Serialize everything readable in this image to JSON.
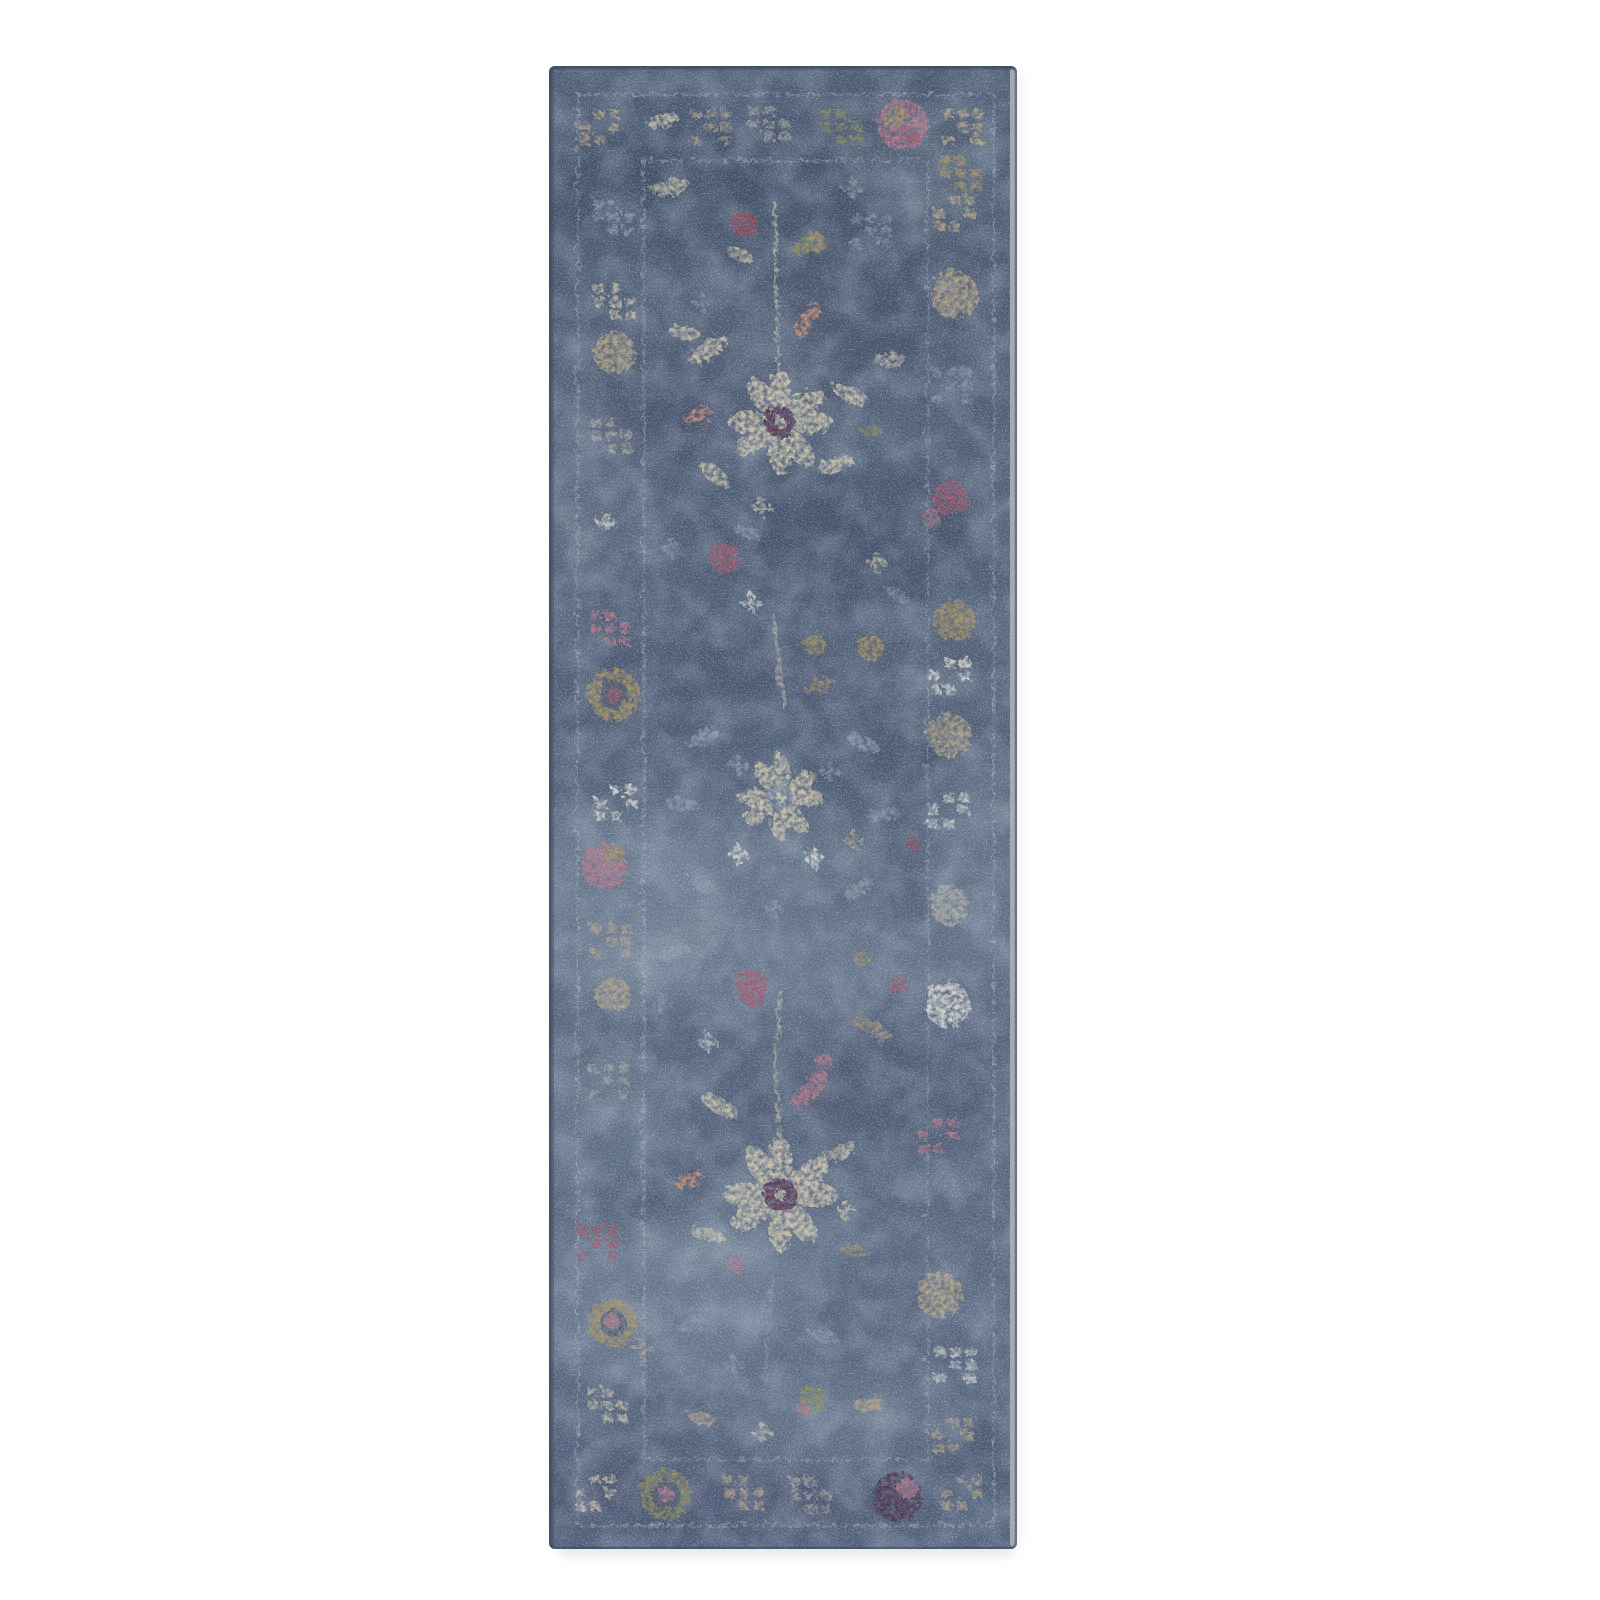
{
  "page": {
    "background_color": "#ffffff"
  },
  "photo": {
    "alt": "Product photo of a vintage-style distressed runner rug in slate blue with faded multicolor floral motifs in cream, beige, gold, olive, pink and rose, framed by a tone-on-tone bordered edge, on a plain white background",
    "width_px": 1600,
    "height_px": 1600
  },
  "rug": {
    "x": 549,
    "y": 66,
    "width": 468,
    "height": 1483,
    "corner_radius": 6,
    "palette": {
      "cream": "#d8cdb0",
      "beige": "#c2ad86",
      "gold": "#b0985e",
      "olive": "#8f9054",
      "dim": "#97a5b4",
      "white": "#e8e5d9",
      "graycream": "#c6c0ae",
      "pink": "#c2798a",
      "rose": "#ae5468",
      "red": "#a84352",
      "salmon": "#cf8f72",
      "maroon": "#5d2b44",
      "purple": "#4c2b46",
      "line": "#b6c0ca",
      "edge": "#a9b0b8",
      "patch_dark": "#2f3b52",
      "patch_light": "#94a4b4",
      "edge_shade": "#434e60",
      "outline": "#38445a",
      "shadow": "#cfd3d6"
    },
    "guard_lines": [
      {
        "inset": 26,
        "o": 0.55
      },
      {
        "inset": 92,
        "o": 0.5
      }
    ],
    "patches": [
      [
        707,
        190,
        170,
        60,
        "d",
        0.32
      ],
      [
        880,
        300,
        90,
        80,
        "d",
        0.25
      ],
      [
        640,
        420,
        80,
        50,
        "d",
        0.22
      ],
      [
        845,
        540,
        130,
        70,
        "d",
        0.3
      ],
      [
        700,
        690,
        120,
        45,
        "d",
        0.22
      ],
      [
        870,
        760,
        90,
        50,
        "d",
        0.2
      ],
      [
        640,
        1180,
        70,
        60,
        "d",
        0.2
      ],
      [
        865,
        1095,
        120,
        55,
        "d",
        0.25
      ],
      [
        700,
        1500,
        190,
        45,
        "d",
        0.22
      ],
      [
        950,
        1450,
        70,
        50,
        "d",
        0.2
      ],
      [
        615,
        905,
        110,
        95,
        "l",
        0.35
      ],
      [
        770,
        960,
        170,
        55,
        "l",
        0.28
      ],
      [
        660,
        1300,
        140,
        80,
        "l",
        0.3
      ],
      [
        850,
        1420,
        120,
        45,
        "l",
        0.22
      ],
      [
        600,
        1120,
        80,
        70,
        "l",
        0.25
      ],
      [
        980,
        870,
        50,
        120,
        "l",
        0.22
      ],
      [
        760,
        1240,
        90,
        40,
        "l",
        0.2
      ],
      [
        930,
        180,
        60,
        40,
        "l",
        0.18
      ],
      [
        580,
        480,
        50,
        90,
        "l",
        0.2
      ],
      [
        760,
        860,
        120,
        40,
        "l",
        0.25
      ]
    ],
    "motifs": [
      {
        "t": "blocks",
        "x": 596,
        "y": 124,
        "c": "beige"
      },
      {
        "t": "leaf",
        "x": 660,
        "y": 118,
        "w": 16,
        "h": 7,
        "rot": -15,
        "c": "cream"
      },
      {
        "t": "blocks",
        "x": 708,
        "y": 124,
        "c": "beige",
        "o": 0.7
      },
      {
        "t": "blocks",
        "x": 766,
        "y": 121,
        "c": "graycream",
        "o": 0.6
      },
      {
        "t": "blocks",
        "x": 838,
        "y": 124,
        "c": "olive",
        "o": 0.75
      },
      {
        "t": "ball",
        "x": 900,
        "y": 122,
        "r": 26,
        "c": "pink"
      },
      {
        "t": "ball",
        "x": 893,
        "y": 114,
        "r": 12,
        "c": "gold",
        "o": 0.8
      },
      {
        "t": "ball",
        "x": 909,
        "y": 133,
        "r": 9,
        "c": "rose",
        "o": 0.8
      },
      {
        "t": "blocks",
        "x": 960,
        "y": 124,
        "c": "beige",
        "o": 0.85
      },
      {
        "t": "blocks",
        "x": 610,
        "y": 214,
        "c": "dim",
        "o": 0.75
      },
      {
        "t": "blocks",
        "x": 612,
        "y": 299,
        "c": "cream",
        "o": 0.8
      },
      {
        "t": "ball",
        "x": 612,
        "y": 350,
        "r": 21,
        "c": "beige"
      },
      {
        "t": "blocks",
        "x": 608,
        "y": 432,
        "c": "graycream",
        "o": 0.6
      },
      {
        "t": "star",
        "x": 604,
        "y": 520,
        "c": "white",
        "o": 0.8
      },
      {
        "t": "blocks",
        "x": 607,
        "y": 625,
        "c": "pink",
        "o": 0.85
      },
      {
        "t": "ring",
        "x": 611,
        "y": 692,
        "r": 26,
        "c": "gold",
        "c2": "rose"
      },
      {
        "t": "blocks",
        "x": 613,
        "y": 800,
        "c": "white",
        "o": 0.85
      },
      {
        "t": "ball",
        "x": 602,
        "y": 864,
        "r": 23,
        "c": "pink"
      },
      {
        "t": "ball",
        "x": 612,
        "y": 852,
        "r": 10,
        "c": "gold",
        "o": 0.85
      },
      {
        "t": "blocks",
        "x": 608,
        "y": 938,
        "c": "beige",
        "o": 0.7
      },
      {
        "t": "ball",
        "x": 610,
        "y": 992,
        "r": 18,
        "c": "beige",
        "o": 0.8
      },
      {
        "t": "blocks",
        "x": 606,
        "y": 1078,
        "c": "graycream",
        "o": 0.6
      },
      {
        "t": "blocks",
        "x": 594,
        "y": 1240,
        "c": "rose",
        "o": 0.8
      },
      {
        "t": "ring",
        "x": 610,
        "y": 1320,
        "r": 24,
        "c": "gold",
        "c2": "pink"
      },
      {
        "t": "blocks",
        "x": 604,
        "y": 1402,
        "c": "cream",
        "o": 0.75
      },
      {
        "t": "blocks",
        "x": 957,
        "y": 170,
        "c": "gold",
        "o": 0.8
      },
      {
        "t": "blocks",
        "x": 951,
        "y": 210,
        "c": "beige",
        "o": 0.8
      },
      {
        "t": "ball",
        "x": 952,
        "y": 292,
        "r": 24,
        "c": "beige",
        "o": 0.85
      },
      {
        "t": "blocks",
        "x": 948,
        "y": 382,
        "c": "dim",
        "o": 0.6
      },
      {
        "t": "ball",
        "x": 948,
        "y": 496,
        "r": 18,
        "c": "rose",
        "o": 0.85
      },
      {
        "t": "ball",
        "x": 952,
        "y": 618,
        "r": 21,
        "c": "gold",
        "o": 0.85
      },
      {
        "t": "blocks",
        "x": 947,
        "y": 673,
        "c": "white",
        "o": 0.85
      },
      {
        "t": "ball",
        "x": 947,
        "y": 733,
        "r": 22,
        "c": "beige",
        "o": 0.8
      },
      {
        "t": "blocks",
        "x": 945,
        "y": 807,
        "c": "white",
        "o": 0.75
      },
      {
        "t": "ball",
        "x": 947,
        "y": 903,
        "r": 20,
        "c": "graycream",
        "o": 0.7
      },
      {
        "t": "ball",
        "x": 910,
        "y": 842,
        "r": 6,
        "c": "red",
        "o": 0.7
      },
      {
        "t": "ball",
        "x": 945,
        "y": 1002,
        "r": 23,
        "c": "white",
        "o": 0.9
      },
      {
        "t": "blocks",
        "x": 935,
        "y": 1132,
        "c": "pink",
        "o": 0.8
      },
      {
        "t": "ball",
        "x": 937,
        "y": 1292,
        "r": 23,
        "c": "beige",
        "o": 0.85
      },
      {
        "t": "blocks",
        "x": 952,
        "y": 1362,
        "c": "white",
        "o": 0.7
      },
      {
        "t": "blocks",
        "x": 950,
        "y": 1432,
        "c": "beige",
        "o": 0.7
      },
      {
        "t": "blocks",
        "x": 592,
        "y": 1490,
        "c": "cream",
        "o": 0.8
      },
      {
        "t": "ring",
        "x": 663,
        "y": 1492,
        "r": 26,
        "c": "olive",
        "c2": "pink"
      },
      {
        "t": "blocks",
        "x": 741,
        "y": 1490,
        "c": "beige",
        "o": 0.8
      },
      {
        "t": "blocks",
        "x": 808,
        "y": 1492,
        "c": "graycream",
        "o": 0.6
      },
      {
        "t": "ball",
        "x": 895,
        "y": 1494,
        "r": 25,
        "c": "purple"
      },
      {
        "t": "ball",
        "x": 905,
        "y": 1486,
        "r": 10,
        "c": "pink",
        "o": 0.85
      },
      {
        "t": "blocks",
        "x": 958,
        "y": 1490,
        "c": "beige",
        "o": 0.75
      },
      {
        "t": "leaf",
        "x": 668,
        "y": 185,
        "w": 20,
        "h": 8,
        "rot": -10,
        "c": "cream",
        "o": 0.8
      },
      {
        "t": "star",
        "x": 850,
        "y": 186,
        "c": "dim",
        "o": 0.7
      },
      {
        "t": "blocks",
        "x": 868,
        "y": 228,
        "c": "dim",
        "o": 0.65
      },
      {
        "t": "stem",
        "x": 772,
        "y": 200,
        "x2": 776,
        "y2": 395,
        "c": "cream",
        "o": 0.7
      },
      {
        "t": "ball",
        "x": 742,
        "y": 221,
        "r": 13,
        "c": "red",
        "o": 0.85
      },
      {
        "t": "leaf",
        "x": 800,
        "y": 243,
        "w": 16,
        "h": 7,
        "rot": -30,
        "c": "olive"
      },
      {
        "t": "ball",
        "x": 813,
        "y": 240,
        "r": 10,
        "c": "gold",
        "o": 0.8
      },
      {
        "t": "leaf",
        "x": 737,
        "y": 252,
        "w": 14,
        "h": 6,
        "rot": 20,
        "c": "cream",
        "o": 0.8
      },
      {
        "t": "leaf",
        "x": 806,
        "y": 318,
        "w": 20,
        "h": 7,
        "rot": -55,
        "c": "salmon",
        "o": 0.9
      },
      {
        "t": "star",
        "x": 700,
        "y": 300,
        "c": "dim",
        "o": 0.6
      },
      {
        "t": "flower",
        "x": 778,
        "y": 420,
        "r": 52,
        "c": "cream",
        "c2": "maroon"
      },
      {
        "t": "leaf",
        "x": 706,
        "y": 348,
        "w": 22,
        "h": 9,
        "rot": -35,
        "c": "cream"
      },
      {
        "t": "leaf",
        "x": 682,
        "y": 330,
        "w": 16,
        "h": 7,
        "rot": 10,
        "c": "cream",
        "o": 0.8
      },
      {
        "t": "bird",
        "x": 695,
        "y": 413,
        "c": "salmon"
      },
      {
        "t": "leaf",
        "x": 848,
        "y": 392,
        "w": 20,
        "h": 8,
        "rot": 25,
        "c": "cream",
        "o": 0.9
      },
      {
        "t": "leaf",
        "x": 887,
        "y": 357,
        "w": 16,
        "h": 7,
        "rot": -5,
        "c": "graycream",
        "o": 0.8
      },
      {
        "t": "leaf",
        "x": 833,
        "y": 462,
        "w": 20,
        "h": 8,
        "rot": -15,
        "c": "cream",
        "o": 0.9
      },
      {
        "t": "leaf",
        "x": 712,
        "y": 472,
        "w": 18,
        "h": 8,
        "rot": 40,
        "c": "cream",
        "o": 0.85
      },
      {
        "t": "star",
        "x": 760,
        "y": 505,
        "c": "cream",
        "o": 0.8
      },
      {
        "t": "leaf",
        "x": 868,
        "y": 428,
        "w": 12,
        "h": 5,
        "rot": 0,
        "c": "olive",
        "o": 0.8
      },
      {
        "t": "ball",
        "x": 722,
        "y": 556,
        "r": 15,
        "c": "rose",
        "o": 0.85
      },
      {
        "t": "star",
        "x": 748,
        "y": 600,
        "c": "white",
        "o": 0.9
      },
      {
        "t": "stem",
        "x": 770,
        "y": 612,
        "x2": 782,
        "y2": 705,
        "c": "cream",
        "o": 0.6
      },
      {
        "t": "ball",
        "x": 812,
        "y": 642,
        "r": 11,
        "c": "gold",
        "o": 0.8
      },
      {
        "t": "ball",
        "x": 868,
        "y": 645,
        "r": 13,
        "c": "gold",
        "o": 0.85
      },
      {
        "t": "leaf",
        "x": 818,
        "y": 684,
        "w": 16,
        "h": 7,
        "rot": -20,
        "c": "gold",
        "o": 0.7
      },
      {
        "t": "star",
        "x": 668,
        "y": 545,
        "c": "dim",
        "o": 0.6
      },
      {
        "t": "leaf",
        "x": 745,
        "y": 530,
        "w": 14,
        "h": 6,
        "rot": 15,
        "c": "dim",
        "o": 0.7
      },
      {
        "t": "ball",
        "x": 928,
        "y": 515,
        "r": 9,
        "c": "pink",
        "o": 0.7
      },
      {
        "t": "star",
        "x": 874,
        "y": 560,
        "c": "cream",
        "o": 0.7
      },
      {
        "t": "leaf",
        "x": 895,
        "y": 592,
        "w": 14,
        "h": 6,
        "rot": 30,
        "c": "dim",
        "o": 0.6
      },
      {
        "t": "flower",
        "x": 778,
        "y": 795,
        "r": 42,
        "c": "cream",
        "c2": "dim"
      },
      {
        "t": "leaf",
        "x": 700,
        "y": 735,
        "w": 18,
        "h": 7,
        "rot": -30,
        "c": "dim",
        "o": 0.8
      },
      {
        "t": "leaf",
        "x": 860,
        "y": 740,
        "w": 18,
        "h": 7,
        "rot": 25,
        "c": "dim",
        "o": 0.8
      },
      {
        "t": "star",
        "x": 735,
        "y": 762,
        "c": "dim",
        "o": 0.8
      },
      {
        "t": "star",
        "x": 828,
        "y": 770,
        "c": "dim",
        "o": 0.7
      },
      {
        "t": "leaf",
        "x": 680,
        "y": 802,
        "w": 16,
        "h": 7,
        "rot": 5,
        "c": "dim",
        "o": 0.7
      },
      {
        "t": "leaf",
        "x": 880,
        "y": 812,
        "w": 16,
        "h": 7,
        "rot": -10,
        "c": "dim",
        "o": 0.7
      },
      {
        "t": "star",
        "x": 735,
        "y": 852,
        "c": "white"
      },
      {
        "t": "star",
        "x": 812,
        "y": 856,
        "c": "white",
        "o": 0.9
      },
      {
        "t": "leaf",
        "x": 700,
        "y": 882,
        "w": 16,
        "h": 7,
        "rot": 35,
        "c": "dim",
        "o": 0.7
      },
      {
        "t": "leaf",
        "x": 856,
        "y": 886,
        "w": 16,
        "h": 7,
        "rot": -30,
        "c": "dim",
        "o": 0.7
      },
      {
        "t": "star",
        "x": 772,
        "y": 906,
        "c": "dim",
        "o": 0.7
      },
      {
        "t": "star",
        "x": 852,
        "y": 838,
        "c": "beige",
        "o": 0.8
      },
      {
        "t": "ball",
        "x": 750,
        "y": 986,
        "r": 17,
        "c": "rose",
        "o": 0.9
      },
      {
        "t": "ball",
        "x": 895,
        "y": 982,
        "r": 10,
        "c": "rose",
        "o": 0.7
      },
      {
        "t": "stem",
        "x": 778,
        "y": 988,
        "x2": 772,
        "y2": 1082,
        "c": "cream",
        "o": 0.6
      },
      {
        "t": "ball",
        "x": 858,
        "y": 956,
        "r": 8,
        "c": "gold",
        "o": 0.75
      },
      {
        "t": "leaf",
        "x": 862,
        "y": 1022,
        "w": 14,
        "h": 6,
        "rot": 15,
        "c": "gold",
        "o": 0.7
      },
      {
        "t": "star",
        "x": 878,
        "y": 1032,
        "c": "beige",
        "o": 0.7
      },
      {
        "t": "leaf",
        "x": 672,
        "y": 950,
        "w": 16,
        "h": 7,
        "rot": -20,
        "c": "dim",
        "o": 0.7
      },
      {
        "t": "star",
        "x": 660,
        "y": 1002,
        "c": "dim",
        "o": 0.6
      },
      {
        "t": "ball",
        "x": 822,
        "y": 1058,
        "r": 8,
        "c": "pink",
        "o": 0.75
      },
      {
        "t": "star",
        "x": 705,
        "y": 1040,
        "c": "white",
        "o": 0.7
      },
      {
        "t": "leaf",
        "x": 807,
        "y": 1087,
        "w": 24,
        "h": 9,
        "rot": -48,
        "c": "pink"
      },
      {
        "t": "leaf",
        "x": 717,
        "y": 1103,
        "w": 20,
        "h": 8,
        "rot": 30,
        "c": "cream",
        "o": 0.9
      },
      {
        "t": "stem",
        "x": 775,
        "y": 1085,
        "x2": 778,
        "y2": 1175,
        "c": "cream",
        "o": 0.65
      },
      {
        "t": "flower",
        "x": 778,
        "y": 1192,
        "r": 56,
        "c": "cream",
        "c2": "maroon"
      },
      {
        "t": "bird",
        "x": 687,
        "y": 1178,
        "c": "salmon"
      },
      {
        "t": "star",
        "x": 843,
        "y": 1208,
        "c": "cream",
        "o": 0.85
      },
      {
        "t": "leaf",
        "x": 838,
        "y": 1150,
        "w": 18,
        "h": 7,
        "rot": -25,
        "c": "cream",
        "o": 0.8
      },
      {
        "t": "leaf",
        "x": 705,
        "y": 1232,
        "w": 18,
        "h": 7,
        "rot": 15,
        "c": "cream",
        "o": 0.8
      },
      {
        "t": "ball",
        "x": 733,
        "y": 1262,
        "r": 8,
        "c": "pink",
        "o": 0.8
      },
      {
        "t": "leaf",
        "x": 852,
        "y": 1248,
        "w": 14,
        "h": 6,
        "rot": 10,
        "c": "gold",
        "o": 0.7
      },
      {
        "t": "stem",
        "x": 770,
        "y": 1270,
        "x2": 762,
        "y2": 1378,
        "c": "dim",
        "o": 0.5
      },
      {
        "t": "leaf",
        "x": 690,
        "y": 1322,
        "w": 16,
        "h": 7,
        "rot": -15,
        "c": "dim",
        "o": 0.6
      },
      {
        "t": "star",
        "x": 730,
        "y": 1362,
        "c": "dim",
        "o": 0.6
      },
      {
        "t": "leaf",
        "x": 820,
        "y": 1332,
        "w": 16,
        "h": 7,
        "rot": 20,
        "c": "dim",
        "o": 0.6
      },
      {
        "t": "ball",
        "x": 810,
        "y": 1396,
        "r": 13,
        "c": "olive",
        "o": 0.85
      },
      {
        "t": "ball",
        "x": 800,
        "y": 1406,
        "r": 6,
        "c": "pink",
        "o": 0.8
      },
      {
        "t": "leaf",
        "x": 868,
        "y": 1402,
        "w": 16,
        "h": 7,
        "rot": -10,
        "c": "beige",
        "o": 0.8
      },
      {
        "t": "star",
        "x": 640,
        "y": 1346,
        "c": "beige",
        "o": 0.7
      },
      {
        "t": "leaf",
        "x": 700,
        "y": 1416,
        "w": 16,
        "h": 7,
        "rot": 20,
        "c": "beige",
        "o": 0.7
      },
      {
        "t": "star",
        "x": 760,
        "y": 1430,
        "c": "cream",
        "o": 0.7
      }
    ]
  }
}
